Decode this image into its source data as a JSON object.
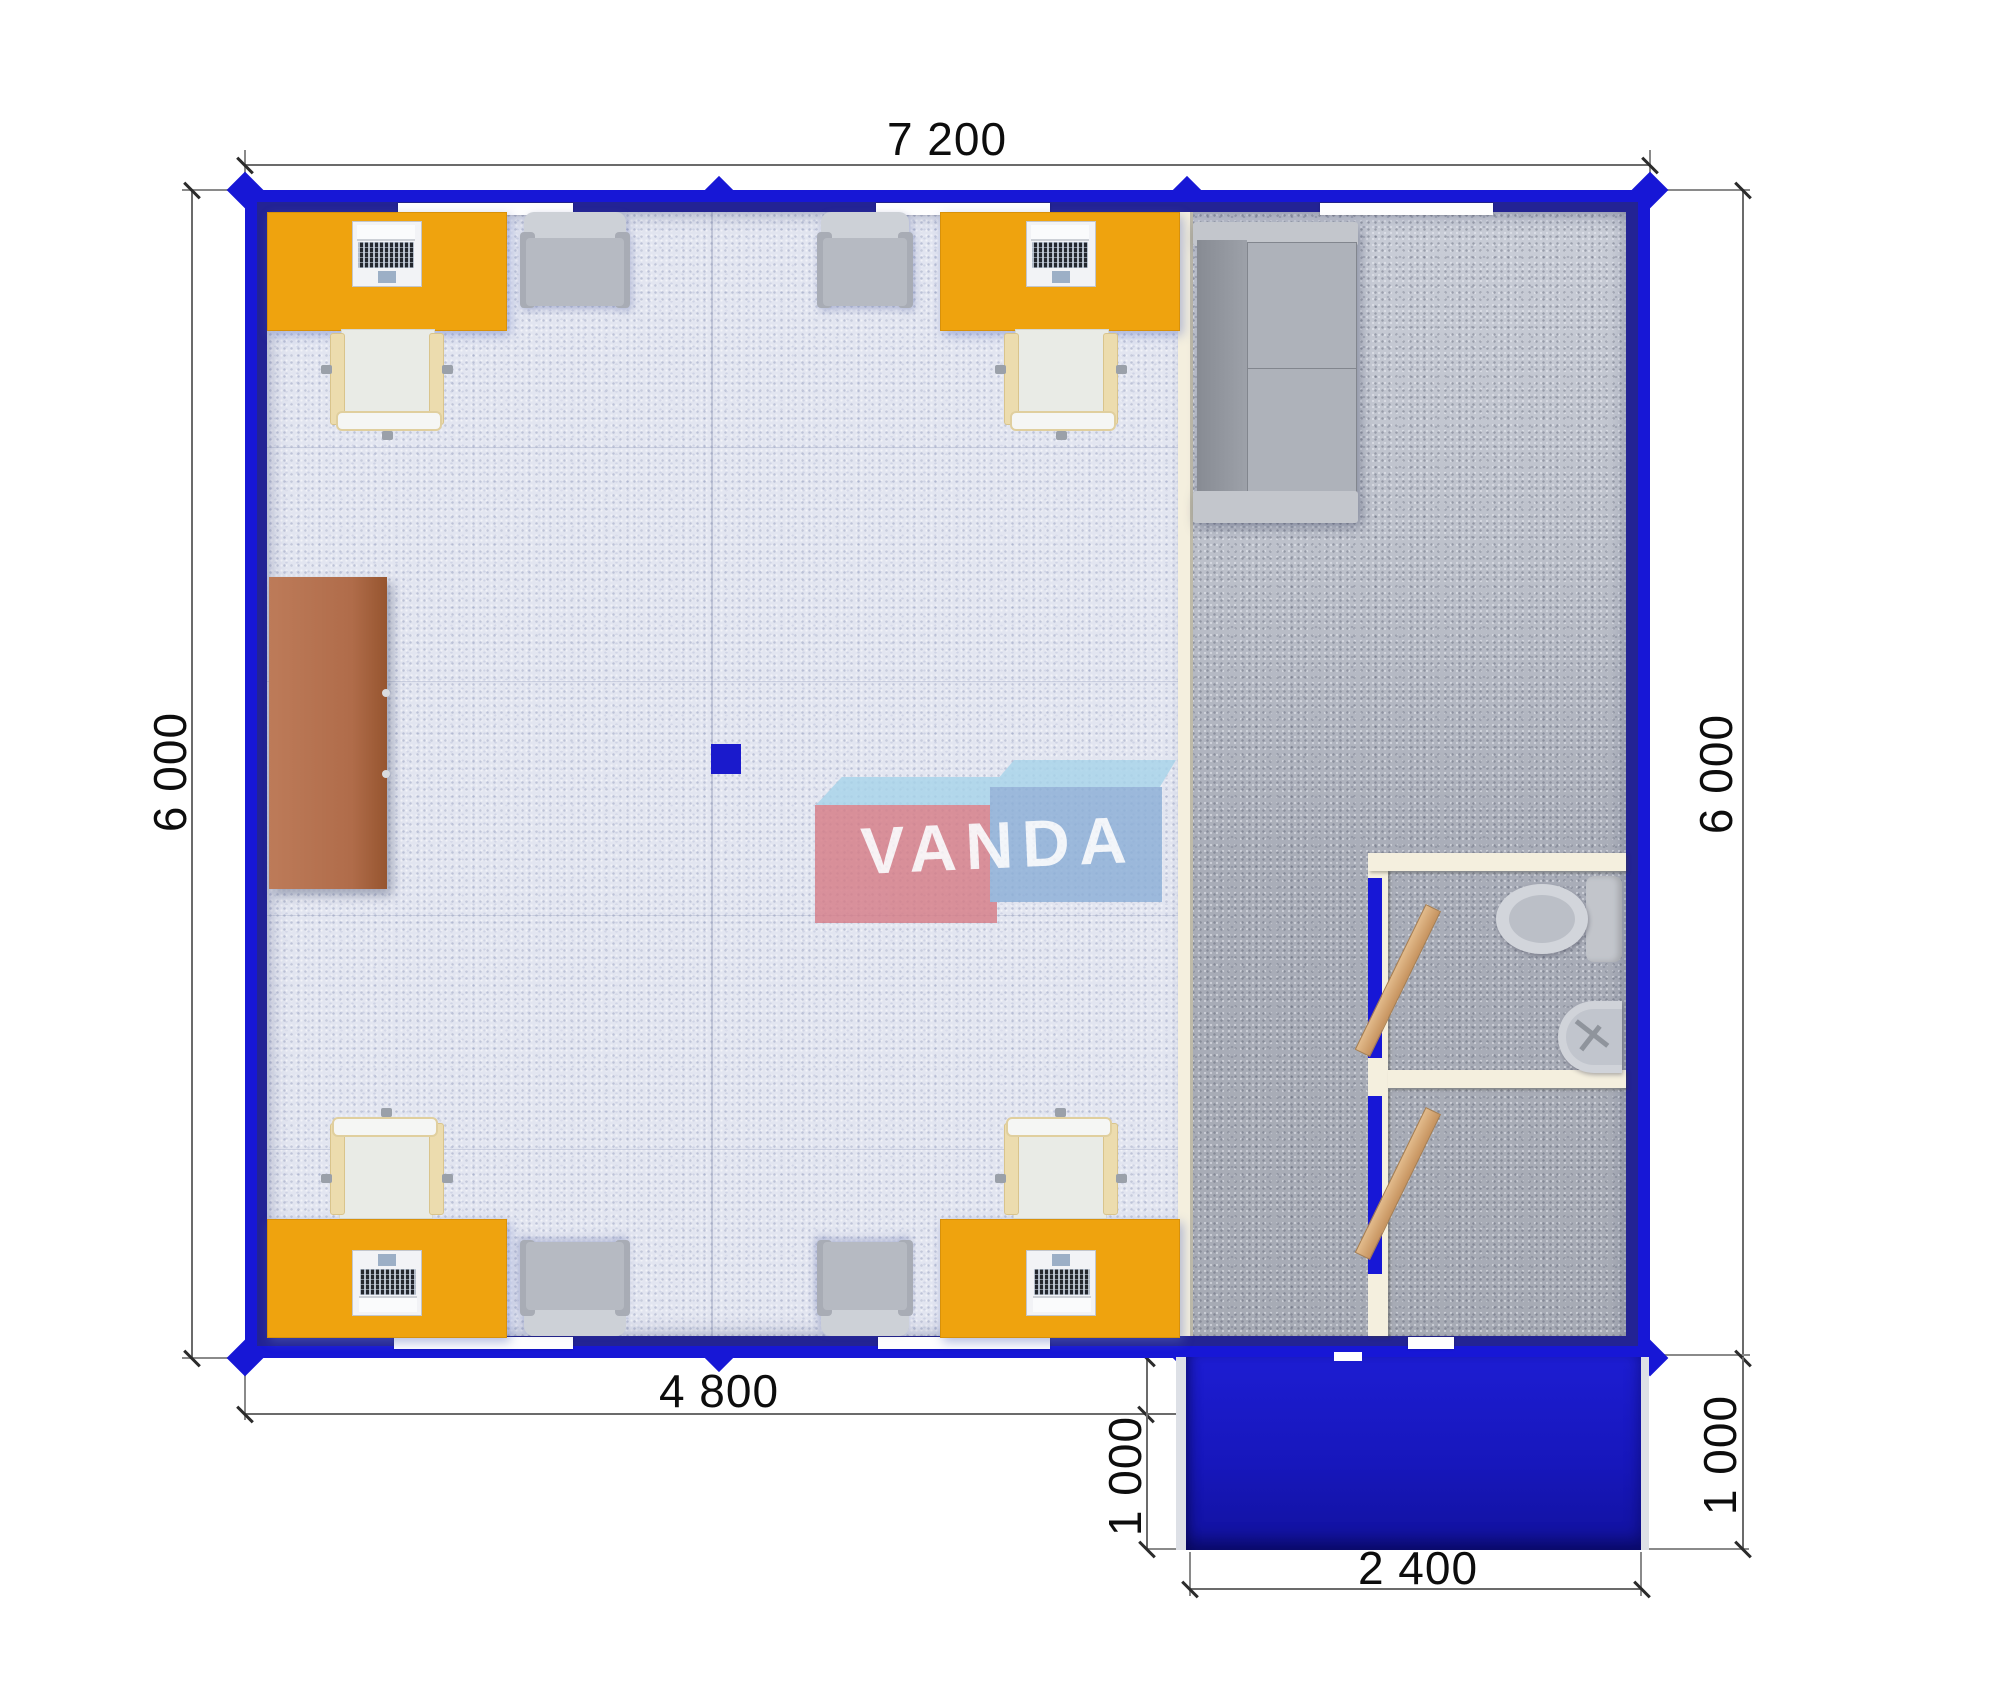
{
  "watermark": {
    "brand": "VANDA"
  },
  "dimensions": {
    "top_width": "7 200",
    "left_height": "6 000",
    "right_height": "6 000",
    "bottom_office_width": "4 800",
    "porch_depth_left": "1 000",
    "porch_depth_right": "1 000",
    "porch_width": "2 400"
  },
  "colors": {
    "wall_blue": "#1717d6",
    "wall_inner_navy": "#232394",
    "desk_orange": "#efa30e",
    "cabinet_terracotta": "#b06c4a",
    "partition_cream": "#f4efde",
    "porch_blue": "#1717bc",
    "office_floor": "#e2e5f0",
    "service_floor": "#b2b6c1",
    "logo_red": "#d67d87",
    "logo_blue": "#8cafd7",
    "logo_top_light_blue": "#a8d4ea"
  }
}
